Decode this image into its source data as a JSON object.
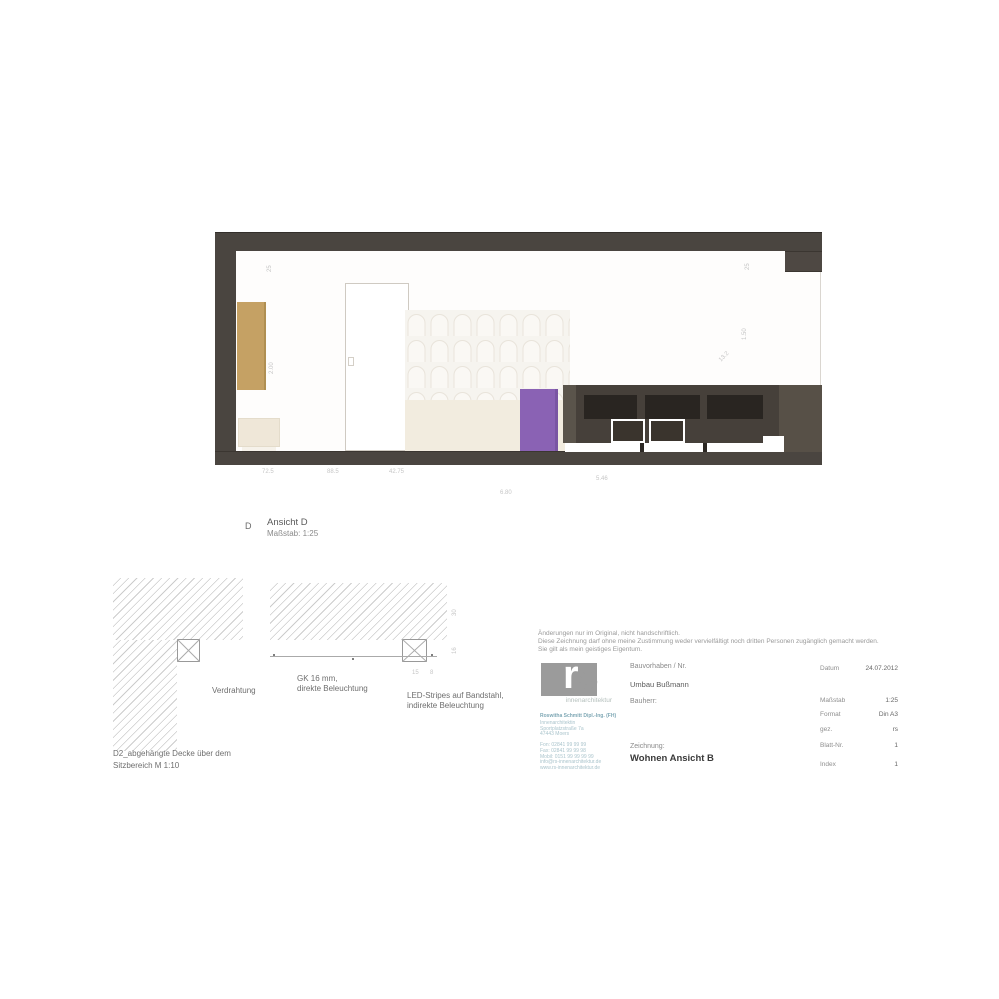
{
  "view_label": {
    "letter": "D",
    "title": "Ansicht D",
    "scale": "Maßstab: 1:25"
  },
  "elevation": {
    "frame_color": "#4a4540",
    "accent_purple": "#8a62b4",
    "accent_tan": "#c5a164",
    "dims": {
      "a": "72.5",
      "b": "88.5",
      "c": "42.75",
      "d": "5.46",
      "total": "6.80",
      "left_top": "25",
      "left_mid": "2.00",
      "right_top": "25",
      "right_mid": "1.50",
      "right_diag": "13.2"
    }
  },
  "detail": {
    "label_wiring": "Verdrahtung",
    "label_gk_1": "GK 16 mm,",
    "label_gk_2": "direkte Beleuchtung",
    "label_led_1": "LED-Stripes auf Bandstahl,",
    "label_led_2": "indirekte Beleuchtung",
    "caption_1": "D2_abgehängte Decke über dem",
    "caption_2": "Sitzbereich M 1:10",
    "dims": {
      "v1": "30",
      "v2": "16",
      "s1": "15",
      "s2": "8"
    }
  },
  "titleblock": {
    "disclaimer": "Änderungen nur im Original, nicht handschriftlich.\nDiese Zeichnung darf ohne meine Zustimmung weder vervielfältigt noch dritten Personen zugänglich gemacht werden.\nSie gilt als mein geistiges Eigentum.",
    "logo": {
      "r": "r",
      "s": "s",
      "subtitle": "innenarchitektur"
    },
    "address_head": "Roswitha Schmitt Dipl.-Ing. (FH)",
    "address_rest": "Innenarchitektin\nSportplatzstraße 7a\n47443 Moers\n\nFon:  02841 99 99 99\nFax:  02841 99 99 98\nMobil: 0151 99 99 99 99\ninfo@rs-innenarchitektur.de\nwww.rs-innenarchitektur.de",
    "fields": {
      "project_label": "Bauvorhaben / Nr.",
      "project_value": "Umbau Bußmann",
      "client_label": "Bauherr:",
      "drawing_label": "Zeichnung:",
      "drawing_title": "Wohnen Ansicht B",
      "date_label": "Datum",
      "date_value": "24.07.2012",
      "scale_label": "Maßstab",
      "scale_value": "1:25",
      "format_label": "Format",
      "format_value": "Din A3",
      "drawn_label": "gez.",
      "drawn_value": "rs",
      "sheet_label": "Blatt-Nr.",
      "sheet_value": "1",
      "index_label": "Index",
      "index_value": "1"
    }
  }
}
